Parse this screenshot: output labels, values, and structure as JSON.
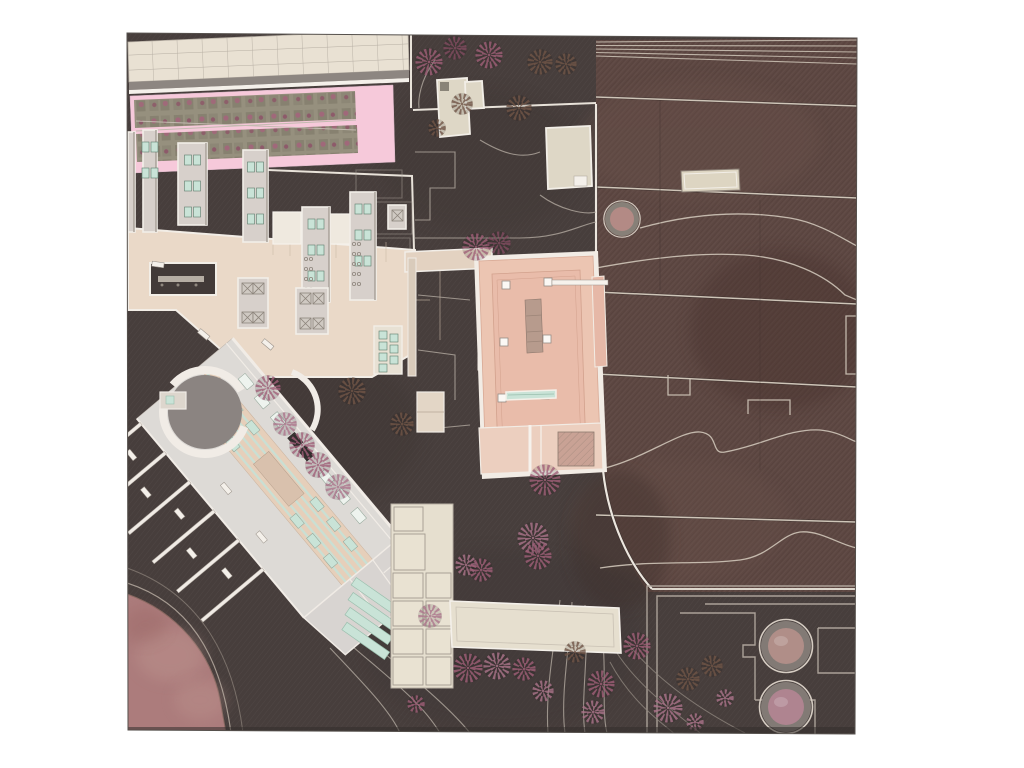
{
  "meta": {
    "title": "Architectural site plan rendering",
    "aria_label": "Top-down architectural masterplan: beige campus buildings with finger wings at upper left over a pink planted band, a salmon courtyard building at center, a diagonal hall building at lower left, dark earth ground with rose-colored trees, terraced red-brown fields on the right, a large mauve earthwork disc at lower left and two circular tanks at lower right"
  },
  "palette": {
    "bg": "#ffffff",
    "ground": "#473e3c",
    "ground_deep": "#3d3534",
    "terrace": "#5d4742",
    "terrace_dark": "#4e3b36",
    "terrace_light": "#6d554d",
    "beige_building": "#e3dcca",
    "grid_hall": "#e9e1d3",
    "grid_line": "#b5ada2",
    "pink": "#f6c9da",
    "plant": "#96907e",
    "plant_dark": "#858070",
    "plaza": "#ead9c8",
    "wing": "#d7d0cb",
    "wing_edge": "#f2eee8",
    "salmon": "#ecc5b2",
    "salmon_dark": "#e9bcaa",
    "salmon_light": "#eccfbf",
    "walk": "#f2ece5",
    "mauve": "#ac7c7c",
    "mauve_light": "#c29b94",
    "mint": "#c9e3d7",
    "mint_dark": "#9bbfae",
    "line": "#b3aaa0",
    "white_line": "#eee8e0",
    "stair": "#b79b8d",
    "courtyard": "#8b8481",
    "tank_ring": "#827a75",
    "tank_rim": "#d5ccc2",
    "plate": "#dddad6",
    "hall": "#e6cfba",
    "spine": "#d9c1ad",
    "dark_table": "#3a3534",
    "notch": "#423a38",
    "shadow": "#8d8681",
    "hatch_sq": "#c9a295"
  },
  "tree_colors": {
    "pink": "#9c5d75",
    "rose": "#a87288",
    "brown": "#6e5345",
    "darkrose": "#7e4a5e"
  },
  "trees": [
    {
      "x": 429,
      "y": 62,
      "r": 14,
      "c": "pink"
    },
    {
      "x": 455,
      "y": 48,
      "r": 12,
      "c": "darkrose"
    },
    {
      "x": 489,
      "y": 55,
      "r": 14,
      "c": "pink"
    },
    {
      "x": 519,
      "y": 108,
      "r": 13,
      "c": "brown"
    },
    {
      "x": 462,
      "y": 104,
      "r": 11,
      "c": "brown"
    },
    {
      "x": 540,
      "y": 62,
      "r": 13,
      "c": "brown"
    },
    {
      "x": 566,
      "y": 64,
      "r": 11,
      "c": "brown"
    },
    {
      "x": 437,
      "y": 128,
      "r": 9,
      "c": "brown"
    },
    {
      "x": 476,
      "y": 247,
      "r": 14,
      "c": "pink"
    },
    {
      "x": 499,
      "y": 243,
      "r": 12,
      "c": "darkrose"
    },
    {
      "x": 268,
      "y": 388,
      "r": 13,
      "c": "pink"
    },
    {
      "x": 352,
      "y": 391,
      "r": 14,
      "c": "brown"
    },
    {
      "x": 285,
      "y": 424,
      "r": 12,
      "c": "rose"
    },
    {
      "x": 302,
      "y": 445,
      "r": 13,
      "c": "pink"
    },
    {
      "x": 318,
      "y": 465,
      "r": 13,
      "c": "pink"
    },
    {
      "x": 338,
      "y": 487,
      "r": 13,
      "c": "rose"
    },
    {
      "x": 402,
      "y": 424,
      "r": 12,
      "c": "brown"
    },
    {
      "x": 545,
      "y": 480,
      "r": 16,
      "c": "pink"
    },
    {
      "x": 533,
      "y": 538,
      "r": 16,
      "c": "rose"
    },
    {
      "x": 538,
      "y": 556,
      "r": 14,
      "c": "pink"
    },
    {
      "x": 466,
      "y": 565,
      "r": 11,
      "c": "rose"
    },
    {
      "x": 481,
      "y": 570,
      "r": 12,
      "c": "pink"
    },
    {
      "x": 430,
      "y": 616,
      "r": 12,
      "c": "rose"
    },
    {
      "x": 468,
      "y": 668,
      "r": 15,
      "c": "pink"
    },
    {
      "x": 497,
      "y": 666,
      "r": 14,
      "c": "rose"
    },
    {
      "x": 524,
      "y": 669,
      "r": 12,
      "c": "pink"
    },
    {
      "x": 543,
      "y": 691,
      "r": 11,
      "c": "rose"
    },
    {
      "x": 416,
      "y": 704,
      "r": 9,
      "c": "pink"
    },
    {
      "x": 593,
      "y": 712,
      "r": 12,
      "c": "rose"
    },
    {
      "x": 601,
      "y": 684,
      "r": 14,
      "c": "pink"
    },
    {
      "x": 637,
      "y": 646,
      "r": 14,
      "c": "pink"
    },
    {
      "x": 668,
      "y": 708,
      "r": 15,
      "c": "rose"
    },
    {
      "x": 688,
      "y": 679,
      "r": 12,
      "c": "brown"
    },
    {
      "x": 712,
      "y": 666,
      "r": 11,
      "c": "brown"
    },
    {
      "x": 725,
      "y": 698,
      "r": 9,
      "c": "rose"
    },
    {
      "x": 575,
      "y": 652,
      "r": 11,
      "c": "brown"
    },
    {
      "x": 695,
      "y": 722,
      "r": 9,
      "c": "rose"
    }
  ],
  "tanks": {
    "small": {
      "cx": 622,
      "cy": 219,
      "r_outer": 17,
      "r_inner": 12,
      "fill": "#b38a85"
    },
    "large": [
      {
        "cx": 786,
        "cy": 646,
        "r_outer": 25,
        "r_inner": 18,
        "fill": "#b08e88"
      },
      {
        "cx": 786,
        "cy": 707,
        "r_outer": 25,
        "r_inner": 18,
        "fill": "#af8490"
      }
    ]
  },
  "terrace_lines": [
    {
      "y1": 97,
      "y2": 106
    },
    {
      "y1": 187,
      "y2": 198
    },
    {
      "y1": 292,
      "y2": 304
    },
    {
      "y1": 374,
      "y2": 387
    },
    {
      "y1": 515,
      "y2": 522
    }
  ],
  "terrace_steps": [
    {
      "y1": 42,
      "y2": 40
    },
    {
      "y1": 45.5,
      "y2": 46
    },
    {
      "y1": 49,
      "y2": 52
    },
    {
      "y1": 52.5,
      "y2": 58
    },
    {
      "y1": 56,
      "y2": 64
    }
  ],
  "terrace_extent": {
    "x1": 596,
    "x2": 857
  }
}
